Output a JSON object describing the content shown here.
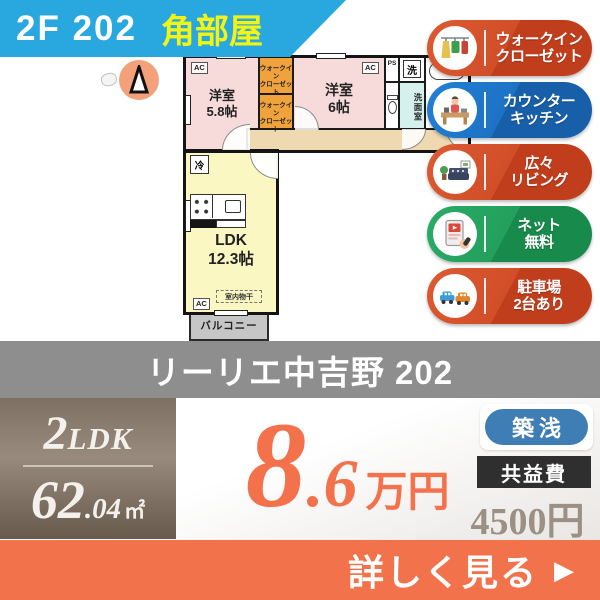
{
  "banner": {
    "unit": "2F 202",
    "corner": "角部屋"
  },
  "plan": {
    "compass_n": "N",
    "room_58": "洋室\n5.8帖",
    "wic": "ウォークイン\nクローゼット",
    "room_6": "洋室\n6帖",
    "ps": "PS",
    "wash": "洗",
    "washroom": "洗面室",
    "ac": "AC",
    "fridge": "冷",
    "ldk": "LDK\n12.3帖",
    "indoor_drying": "室内物干",
    "balcony": "バルコニー"
  },
  "features": [
    {
      "label": "ウォークイン\nクローゼット",
      "icon": "walk-in-closet",
      "color": "#D24E28"
    },
    {
      "label": "カウンター\nキッチン",
      "icon": "counter-kitchen",
      "color": "#1D72C4"
    },
    {
      "label": "広々\nリビング",
      "icon": "spacious-living",
      "color": "#D24E28"
    },
    {
      "label": "ネット\n無料",
      "icon": "free-internet",
      "color": "#22A05C"
    },
    {
      "label": "駐車場\n2台あり",
      "icon": "parking",
      "color": "#D24E28"
    }
  ],
  "title": "リーリエ中吉野 202",
  "summary": {
    "layout_num": "2",
    "layout_type": "LDK",
    "area_int": "62",
    "area_dec": ".04",
    "area_unit": "㎡",
    "rent_int": "8",
    "rent_dec": ".6",
    "rent_unit": "万円",
    "age_badge": "築浅",
    "fee_label": "共益費",
    "fee_value": "4500円"
  },
  "cta": {
    "label": "詳しく見る",
    "arrow": "▶"
  },
  "colors": {
    "banner_blue": "#29A8E0",
    "corner_yellow": "#F4F414",
    "badge_red": "#D24E28",
    "badge_blue": "#1D72C4",
    "badge_green": "#22A05C",
    "title_band_gray": "#8E8E8E",
    "spec_box_taupe": "#8A7D6F",
    "price_orange": "#F3714B",
    "age_pill_blue": "#3F7DB5",
    "fee_box_dark": "#2F2F2F",
    "fee_value_taupe": "#9C9084",
    "cta_orange": "#F2724B",
    "room_pink": "#F7DBDA",
    "wic_orange": "#F0A33C",
    "corridor_tan": "#EFD9B0",
    "ldk_yellow": "#FAF7C3",
    "washroom_cyan": "#D5F1EE",
    "balcony_gray": "#C6C6C6"
  }
}
